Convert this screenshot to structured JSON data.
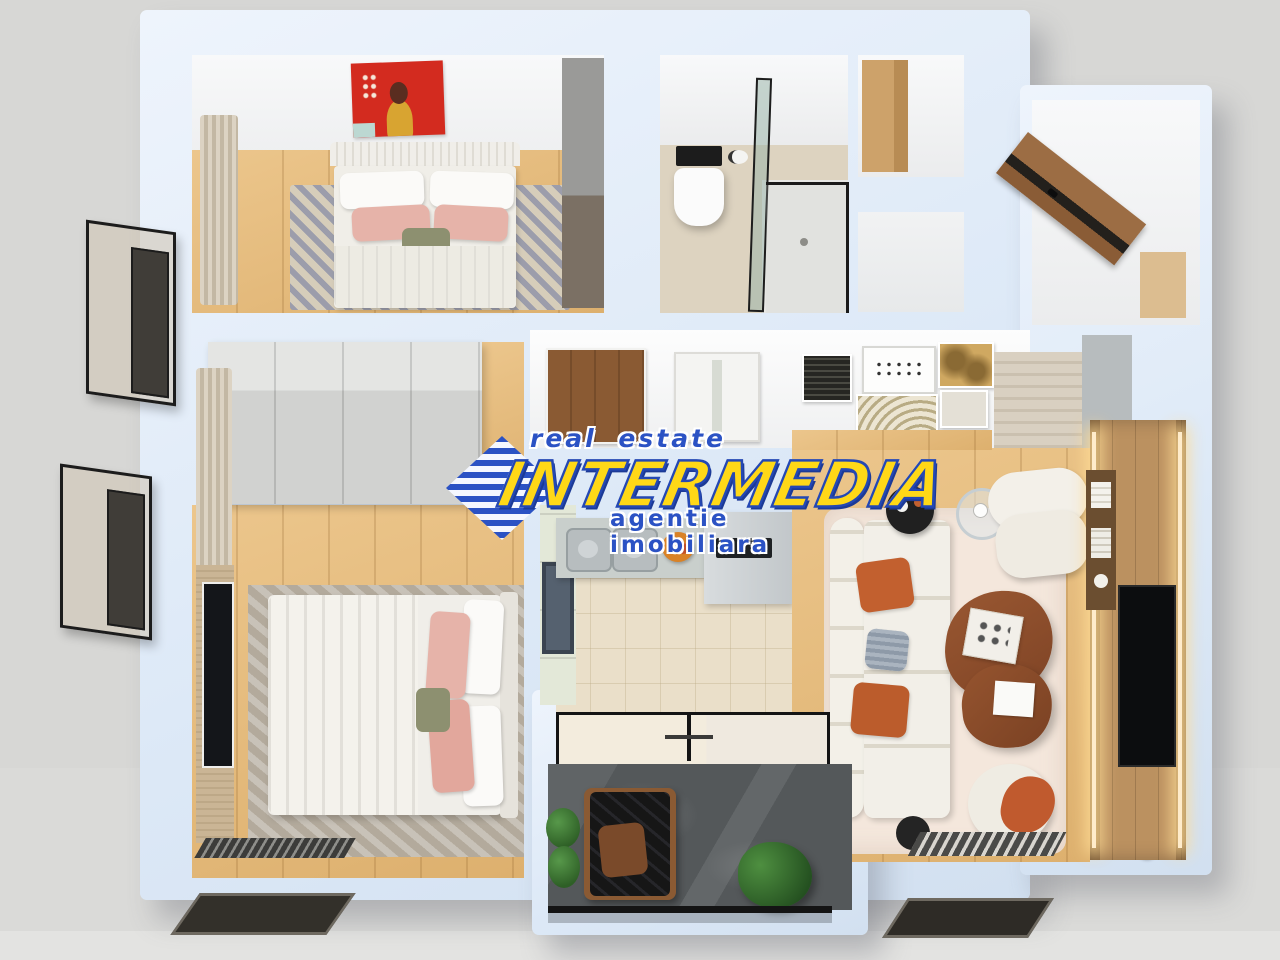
{
  "watermark": {
    "top_line": "real estate",
    "brand": "INTERMEDIA",
    "bottom_line": "agentie imobiliara",
    "colors": {
      "brand_fill": "#FFD817",
      "accent_blue": "#2B52C4",
      "outline": "#FFFFFF"
    }
  },
  "palette": {
    "background": "#D8D8D6",
    "wall": "#DDE9F7",
    "wall_face": "#F8F9FA",
    "wood_floor": "#E2B577",
    "kitchen_tile": "#EADFC9",
    "bathroom_floor": "#DDD3C0",
    "balcony_floor": "#55595B",
    "living_rug": "#F4E7DC",
    "bedroom_rug_stone": "#B3AA9C",
    "bedroom_rug_blue": "#8A94B4",
    "sofa_white": "#F2EFE8",
    "accent_orange": "#C2602F",
    "coffee_table_brown": "#8D4E2B",
    "tv_wall_wood": "#BB9160",
    "led_glow": "#FFE3AE",
    "artwork_red": "#D32B1F",
    "plant_green": "#3F7A33",
    "door_brown": "#8A5A33"
  },
  "scene": {
    "type": "3d-floor-plan-top-down-render",
    "rooms": [
      {
        "name": "bedroom-top-left",
        "items": [
          "red-portrait-artwork",
          "double-bed",
          "white-pillows",
          "pink-pillows",
          "olive-pillow",
          "patterned-rug",
          "curtains",
          "dark-wardrobe"
        ]
      },
      {
        "name": "bathroom",
        "items": [
          "wall-hung-toilet",
          "black-flush-panel",
          "toilet-paper-holder",
          "glass-shower-enclosure",
          "floor-drain"
        ]
      },
      {
        "name": "storage-hall-top",
        "items": [
          "wood-closet"
        ]
      },
      {
        "name": "entry",
        "items": [
          "wooden-entrance-door"
        ]
      },
      {
        "name": "hallway-wall",
        "items": [
          "brown-interior-door",
          "white-interior-door",
          "gallery-wall-frames"
        ]
      },
      {
        "name": "bedroom-bottom-left",
        "items": [
          "large-wardrobe",
          "curtains",
          "tv-panel",
          "television",
          "double-bed",
          "duvet",
          "pink-pillows",
          "stone-pattern-rug",
          "striped-bench"
        ]
      },
      {
        "name": "kitchen",
        "items": [
          "cabinet-column",
          "appliance",
          "counter-with-double-sink",
          "fruit-bowl",
          "refrigerator",
          "microwave"
        ]
      },
      {
        "name": "living-room",
        "items": [
          "modular-sofa",
          "orange-cushions",
          "gray-cushion",
          "black-side-table",
          "glass-side-table",
          "armchair",
          "organic-coffee-table",
          "serving-tray",
          "white-pouf",
          "orange-throw",
          "black-mini-pouf",
          "striped-mat",
          "dried-plant",
          "tv-media-wall",
          "led-strips",
          "television",
          "media-shelf",
          "travertine-wall"
        ]
      },
      {
        "name": "balcony",
        "items": [
          "glass-sliding-doors",
          "slate-floor",
          "lounge-chair",
          "seat-cushion",
          "shrub-planter",
          "potted-plant",
          "railing"
        ]
      },
      {
        "name": "exterior",
        "items": [
          "french-balcony-upper",
          "french-balcony-lower",
          "facade-window-left",
          "facade-window-right"
        ]
      }
    ]
  }
}
